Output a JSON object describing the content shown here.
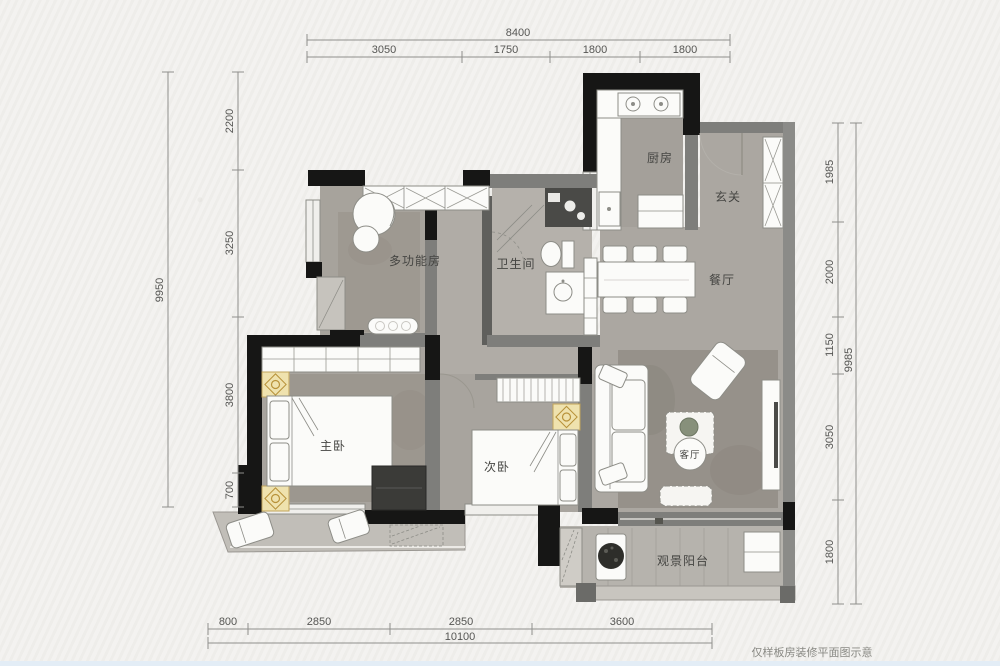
{
  "plan": {
    "caption": "仅样板房装修平面图示意",
    "rooms": {
      "kitchen": "厨房",
      "foyer": "玄关",
      "dining": "餐厅",
      "multifunction": "多功能房",
      "bathroom": "卫生间",
      "master_bedroom": "主卧",
      "second_bedroom": "次卧",
      "living": "客厅",
      "balcony": "观景阳台"
    },
    "dimensions": {
      "top": {
        "total": "8400",
        "segments": [
          "3050",
          "1750",
          "1800",
          "1800"
        ]
      },
      "left": {
        "total": "9950",
        "segments": [
          "2200",
          "3250",
          "3800",
          "700"
        ]
      },
      "right": {
        "total": "9985",
        "segments": [
          "1985",
          "2000",
          "1150",
          "3050",
          "1800"
        ]
      },
      "bottom": {
        "total": "10100",
        "segments": [
          "800",
          "2850",
          "2850",
          "3600"
        ]
      }
    },
    "colors": {
      "wall_black": "#161615",
      "wall_gray": "#7e7e7b",
      "floor_main": "#aba7a1",
      "floor_rug": "#98938b",
      "balcony_floor": "#c1beb8",
      "nightstand": "#efe2ae",
      "nightstand_accent": "#b8923a",
      "paper": "#f3f2ef"
    }
  }
}
